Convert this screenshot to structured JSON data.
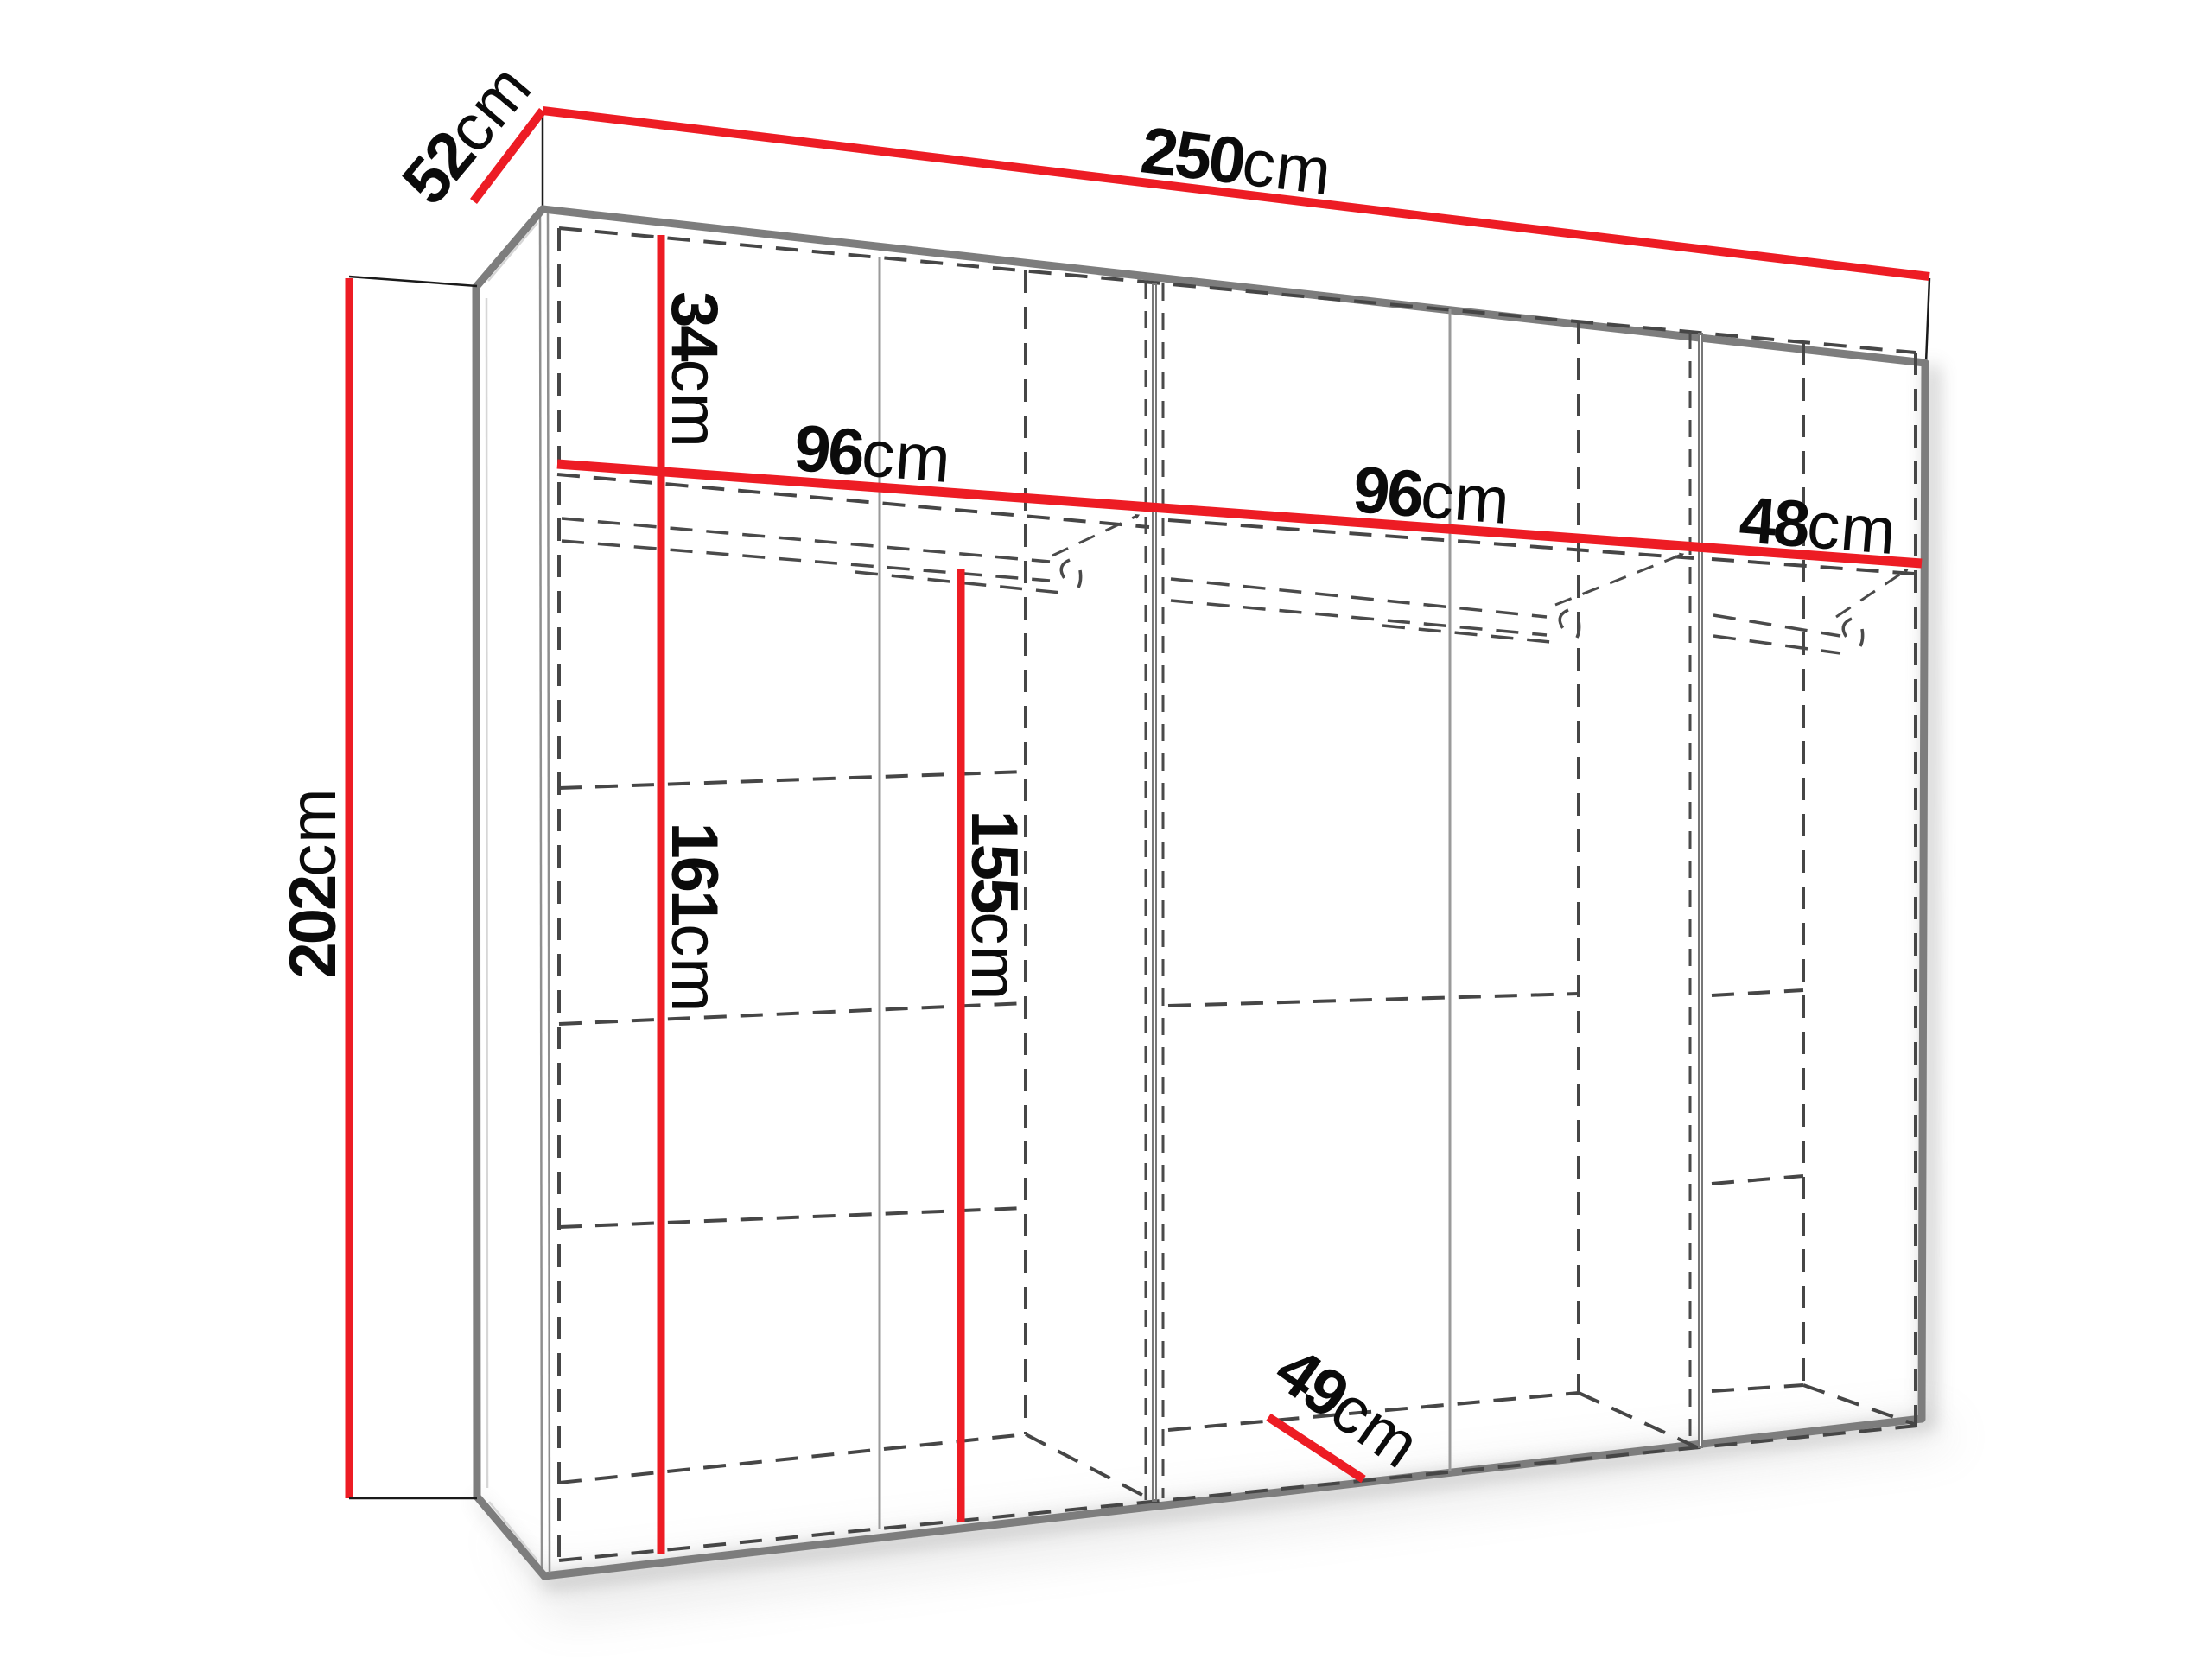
{
  "diagram": {
    "type": "furniture-dimension-diagram",
    "subject": "wardrobe",
    "unit": "cm",
    "labels": {
      "total_width": {
        "value": "250",
        "unit": "cm"
      },
      "depth": {
        "value": "52",
        "unit": "cm"
      },
      "height": {
        "value": "202",
        "unit": "cm"
      },
      "top_shelf_height": {
        "value": "34",
        "unit": "cm"
      },
      "left_section_width": {
        "value": "96",
        "unit": "cm"
      },
      "mid_section_width": {
        "value": "96",
        "unit": "cm"
      },
      "right_section_width": {
        "value": "48",
        "unit": "cm"
      },
      "left_interior_height": {
        "value": "161",
        "unit": "cm"
      },
      "hanging_space_height": {
        "value": "155",
        "unit": "cm"
      },
      "interior_depth": {
        "value": "49",
        "unit": "cm"
      }
    },
    "colors": {
      "dimension_line": "#ED1C24",
      "edge_gray": "#7D7D7D",
      "hidden_line_dash": "#464646",
      "label_text": "#0B0B0B",
      "background": "#FFFFFF"
    }
  }
}
